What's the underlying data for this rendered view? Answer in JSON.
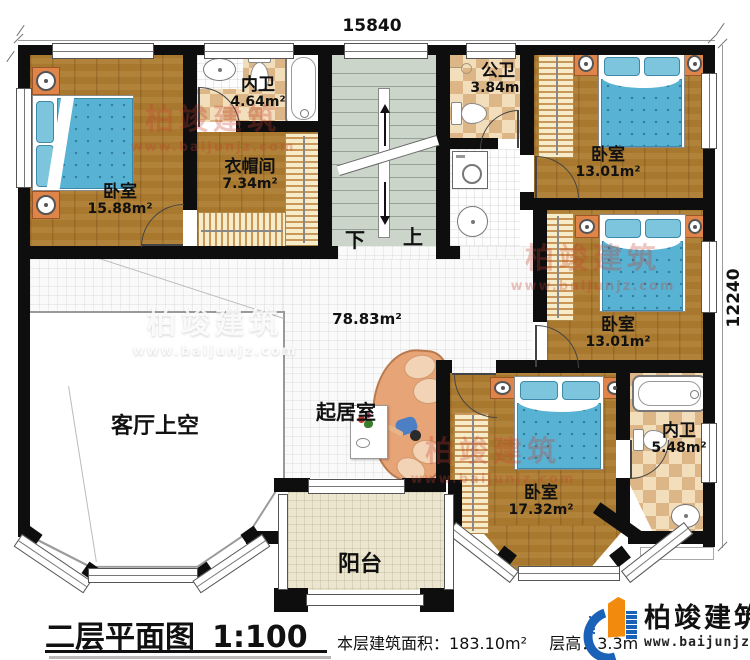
{
  "dimensions": {
    "top": "15840",
    "right": "12240"
  },
  "rooms": {
    "bedroom1": {
      "name": "卧室",
      "area": "15.88m²"
    },
    "bath1": {
      "name": "内卫",
      "area": "4.64m²"
    },
    "cloakroom": {
      "name": "衣帽间",
      "area": "7.34m²"
    },
    "public_bath": {
      "name": "公卫",
      "area": "3.84m²"
    },
    "bedroom2": {
      "name": "卧室",
      "area": "13.01m²"
    },
    "bedroom3": {
      "name": "卧室",
      "area": "13.01m²"
    },
    "bedroom4": {
      "name": "卧室",
      "area": "17.32m²"
    },
    "bath2": {
      "name": "内卫",
      "area": "5.48m²"
    },
    "hall": {
      "area": "78.83m²"
    },
    "sitting_room": {
      "name": "起居室"
    },
    "living_void": {
      "name": "客厅上空"
    },
    "balcony": {
      "name": "阳台"
    }
  },
  "stairs": {
    "down": "下",
    "up": "上"
  },
  "footer": {
    "title": "二层平面图",
    "scale": "1:100",
    "area_label": "本层建筑面积：",
    "area_value": "183.10m²",
    "height_label": "层高：",
    "height_value": "3.3m"
  },
  "brand": {
    "name": "柏竣建筑",
    "url": "www.baijunjz.com"
  },
  "colors": {
    "wall": "#0e0e0e",
    "wood": "#a8782f",
    "blanket": "#57b2d3",
    "watermark_red": "#c63e2d",
    "logo_blue": "#1a62b8",
    "logo_orange": "#f28a0d"
  }
}
